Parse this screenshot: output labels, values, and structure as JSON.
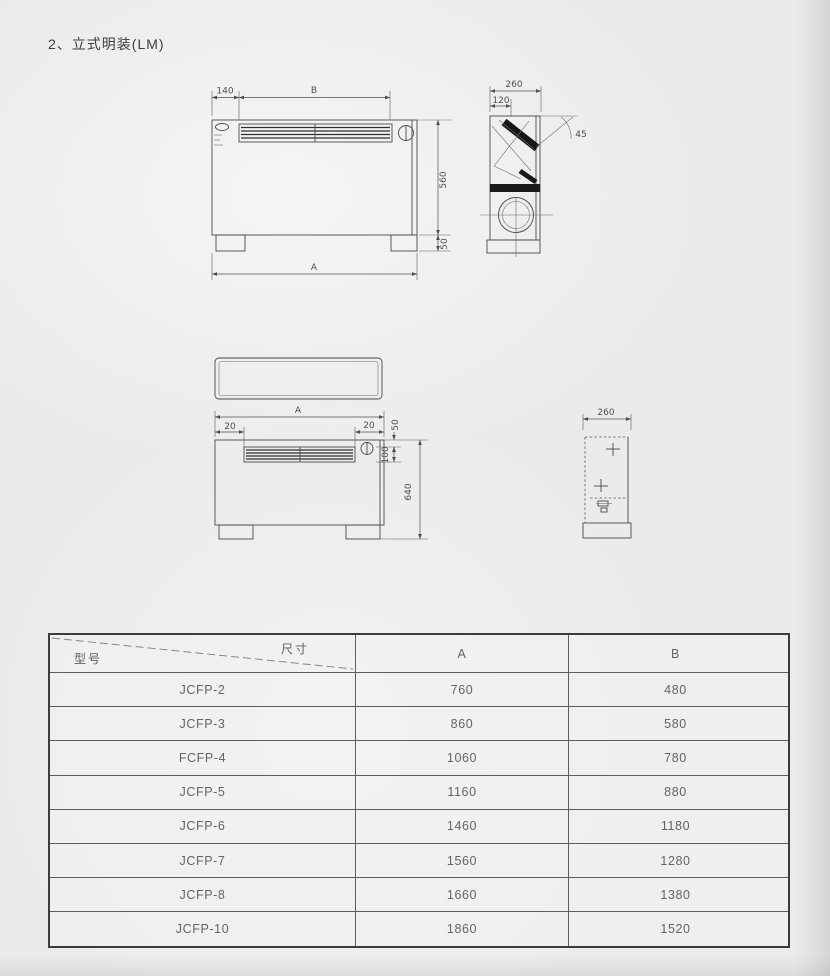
{
  "page": {
    "title": "2、立式明装(LM)"
  },
  "drawings": {
    "front_view": {
      "dims": {
        "d140": "140",
        "dB": "B",
        "d560": "560",
        "d50": "50",
        "dA": "A"
      }
    },
    "side_view": {
      "dims": {
        "d260": "260",
        "d120": "120",
        "d45": "45"
      }
    },
    "mid_front_view": {
      "dims": {
        "dA": "A",
        "d20_left": "20",
        "d20_right": "20",
        "d50": "50",
        "d100": "100",
        "d640": "640"
      }
    },
    "mid_side_view": {
      "dims": {
        "d260": "260"
      }
    }
  },
  "table": {
    "header": {
      "model": "型号",
      "size": "尺寸",
      "col_a": "A",
      "col_b": "B"
    },
    "rows": [
      {
        "model": "JCFP-2",
        "a": "760",
        "b": "480"
      },
      {
        "model": "JCFP-3",
        "a": "860",
        "b": "580"
      },
      {
        "model": "FCFP-4",
        "a": "1060",
        "b": "780"
      },
      {
        "model": "JCFP-5",
        "a": "1160",
        "b": "880"
      },
      {
        "model": "JCFP-6",
        "a": "1460",
        "b": "1180"
      },
      {
        "model": "JCFP-7",
        "a": "1560",
        "b": "1280"
      },
      {
        "model": "JCFP-8",
        "a": "1660",
        "b": "1380"
      },
      {
        "model": "JCFP-10",
        "a": "1860",
        "b": "1520"
      }
    ]
  }
}
